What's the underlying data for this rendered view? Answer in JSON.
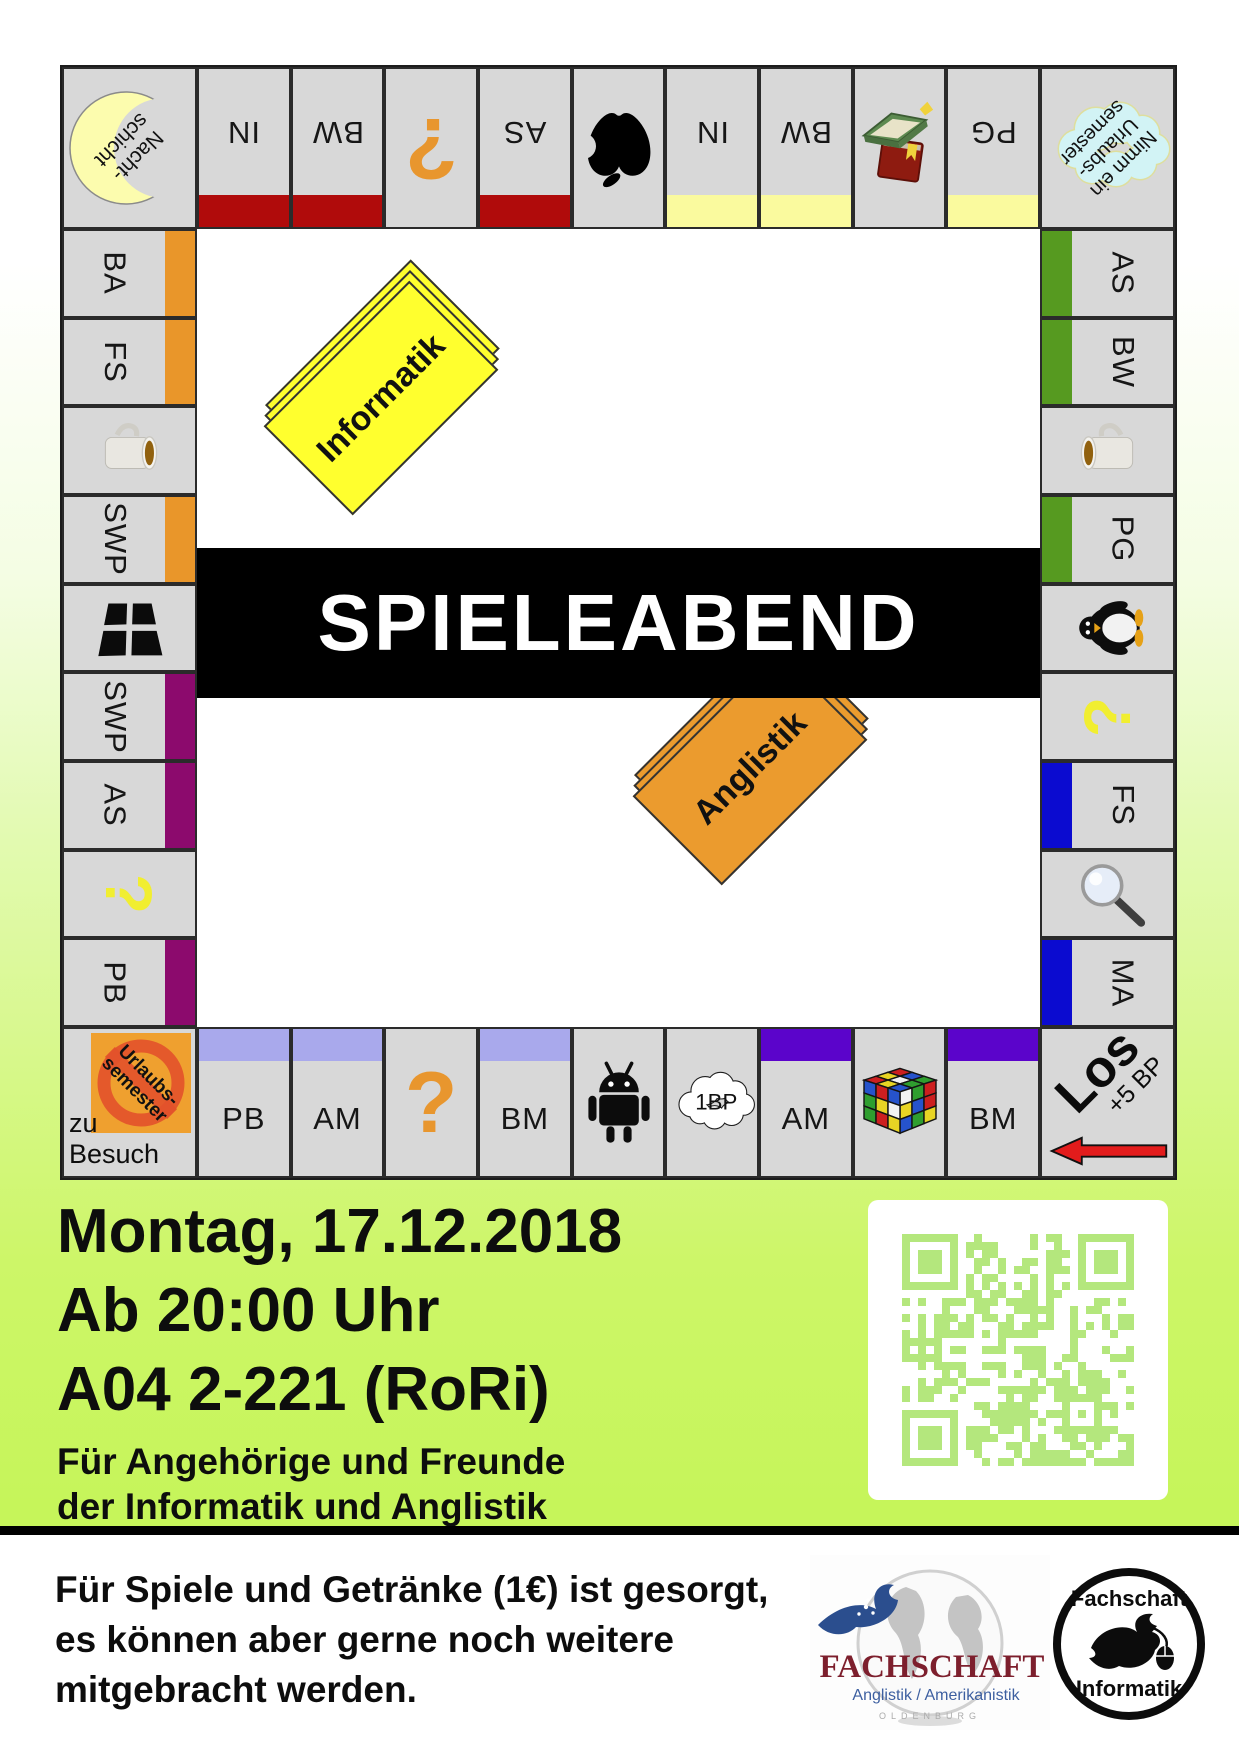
{
  "title": "SPIELEABEND",
  "cards": {
    "yellow": "Informatik",
    "orange": "Anglistik"
  },
  "corners": {
    "top_left": {
      "lines": [
        "Nacht-",
        "schicht"
      ]
    },
    "top_right": {
      "lines": [
        "Nimm ein",
        "Urlaubs-",
        "semester"
      ]
    },
    "bottom_left": {
      "badge": [
        "Urlaubs-",
        "semester"
      ],
      "caption": "zu Besuch"
    },
    "bottom_right": {
      "label": "Los",
      "bonus": "+5 BP"
    }
  },
  "top_row": [
    {
      "t": "IN",
      "bar": "darkred"
    },
    {
      "t": "BW",
      "bar": "darkred"
    },
    {
      "i": "question-orange"
    },
    {
      "t": "AS",
      "bar": "darkred"
    },
    {
      "i": "apple"
    },
    {
      "t": "IN",
      "bar": "paleyellow"
    },
    {
      "t": "BW",
      "bar": "paleyellow"
    },
    {
      "i": "books"
    },
    {
      "t": "PG",
      "bar": "paleyellow"
    }
  ],
  "left_col": [
    {
      "t": "BA",
      "bar": "orange"
    },
    {
      "t": "FS",
      "bar": "orange"
    },
    {
      "i": "mug"
    },
    {
      "t": "SWP",
      "bar": "orange"
    },
    {
      "i": "window"
    },
    {
      "t": "SWP",
      "bar": "purple"
    },
    {
      "t": "AS",
      "bar": "purple"
    },
    {
      "i": "question-yellow"
    },
    {
      "t": "PB",
      "bar": "purple"
    }
  ],
  "right_col": [
    {
      "t": "AS",
      "bar": "green"
    },
    {
      "t": "BW",
      "bar": "green"
    },
    {
      "i": "mug",
      "flip": true
    },
    {
      "t": "PG",
      "bar": "green"
    },
    {
      "i": "penguin"
    },
    {
      "i": "question-yellow"
    },
    {
      "t": "FS",
      "bar": "blue"
    },
    {
      "i": "magnifier"
    },
    {
      "t": "MA",
      "bar": "blue"
    }
  ],
  "bottom_row": [
    {
      "t": "PB",
      "bar": "lavender"
    },
    {
      "t": "AM",
      "bar": "lavender"
    },
    {
      "i": "question-orange"
    },
    {
      "t": "BM",
      "bar": "lavender"
    },
    {
      "i": "android"
    },
    {
      "i": "cloud-1bp",
      "cloud_label": "1BP"
    },
    {
      "t": "AM",
      "bar": "violet"
    },
    {
      "i": "rubik"
    },
    {
      "t": "BM",
      "bar": "violet"
    }
  ],
  "bar_colors": {
    "darkred": "#b00b0b",
    "paleyellow": "#fafa9e",
    "orange": "#e9962a",
    "purple": "#8c0a6d",
    "green": "#569a20",
    "blue": "#0b0bd0",
    "lavender": "#a9a9ec",
    "violet": "#5b04cb"
  },
  "details": {
    "line1": "Montag, 17.12.2018",
    "line2": "Ab 20:00 Uhr",
    "line3": "A04 2-221 (RoRi)",
    "line4": "Für Angehörige und Freunde",
    "line5": "der Informatik und Anglistik"
  },
  "footer": {
    "line1": "Für Spiele und Getränke (1€) ist gesorgt,",
    "line2": "es können aber gerne noch weitere",
    "line3": "mitgebracht werden."
  },
  "logos": {
    "anglistik": {
      "title": "FACHSCHAFT",
      "subtitle": "Anglistik / Amerikanistik",
      "footnote": "OLDENBURG"
    },
    "informatik": {
      "top": "Fachschaft",
      "bottom": "Informatik"
    }
  },
  "qr_color": "#b4e77d"
}
